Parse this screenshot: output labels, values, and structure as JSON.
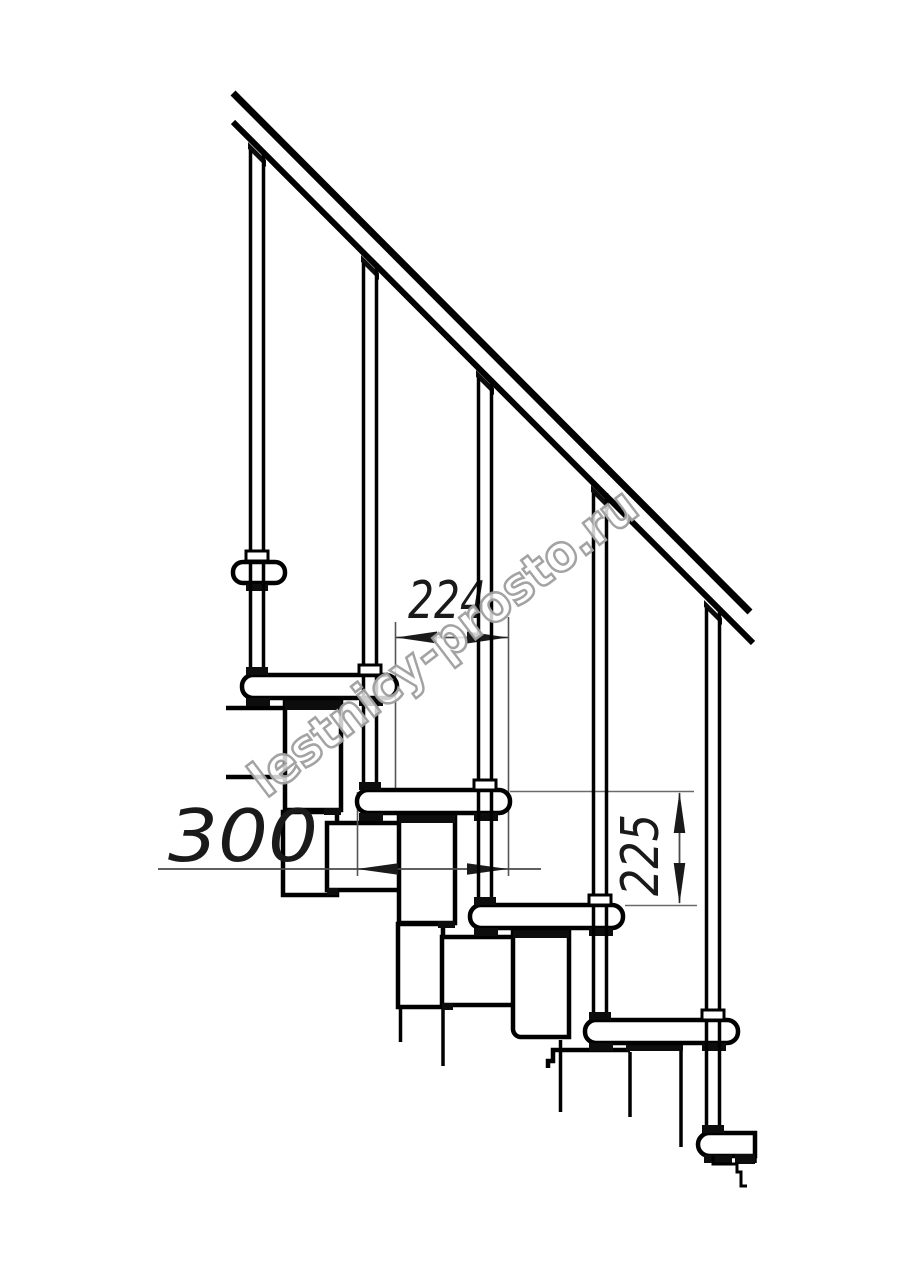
{
  "drawing": {
    "background": "#ffffff",
    "line_color": "#000000",
    "dimension_line_color": "#4a4a4a",
    "dimensions": {
      "run": {
        "label": "224"
      },
      "tread_width": {
        "label": "300"
      },
      "rise": {
        "label": "225"
      }
    },
    "watermark": {
      "text": "lestnicy-prosto.ru",
      "stroke_color": "#9e9e9e"
    }
  }
}
